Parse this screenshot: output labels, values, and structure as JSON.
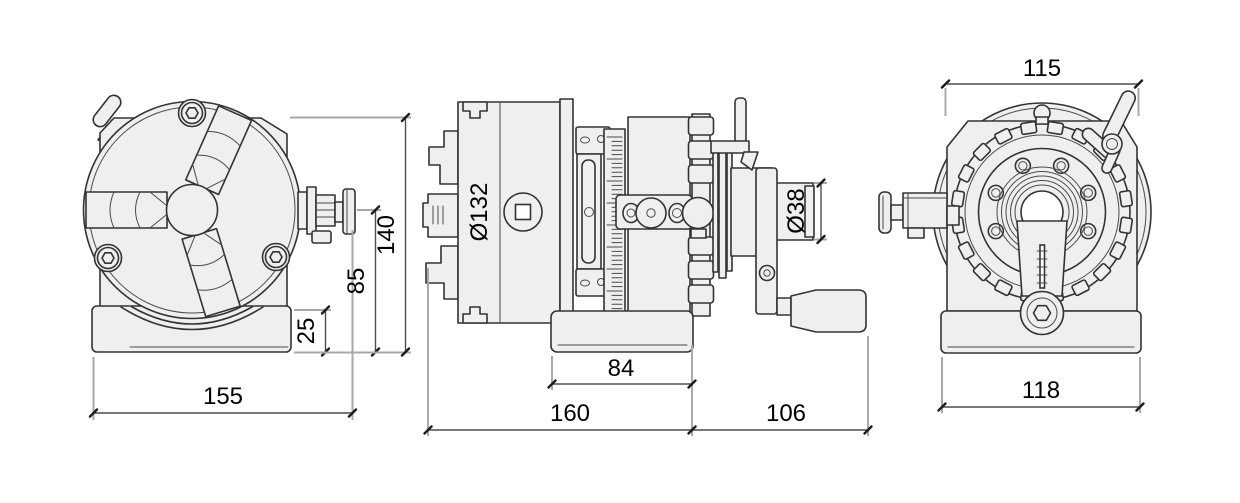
{
  "colors": {
    "background": "#ffffff",
    "part_fill": "#efefef",
    "outline": "#333333",
    "extension_line": "#a8a8a8",
    "dimension_line": "#4d4d4d",
    "label_text": "#000000"
  },
  "dims": {
    "front": {
      "overall_width": "155",
      "base_height": "25",
      "center_height": "85",
      "overall_height": "140"
    },
    "side": {
      "chuck_diameter": "Ø132",
      "base_length": "84",
      "body_length": "160",
      "handle_length": "106",
      "shaft_diameter": "Ø38"
    },
    "rear": {
      "top_width": "115",
      "base_width": "118"
    }
  }
}
